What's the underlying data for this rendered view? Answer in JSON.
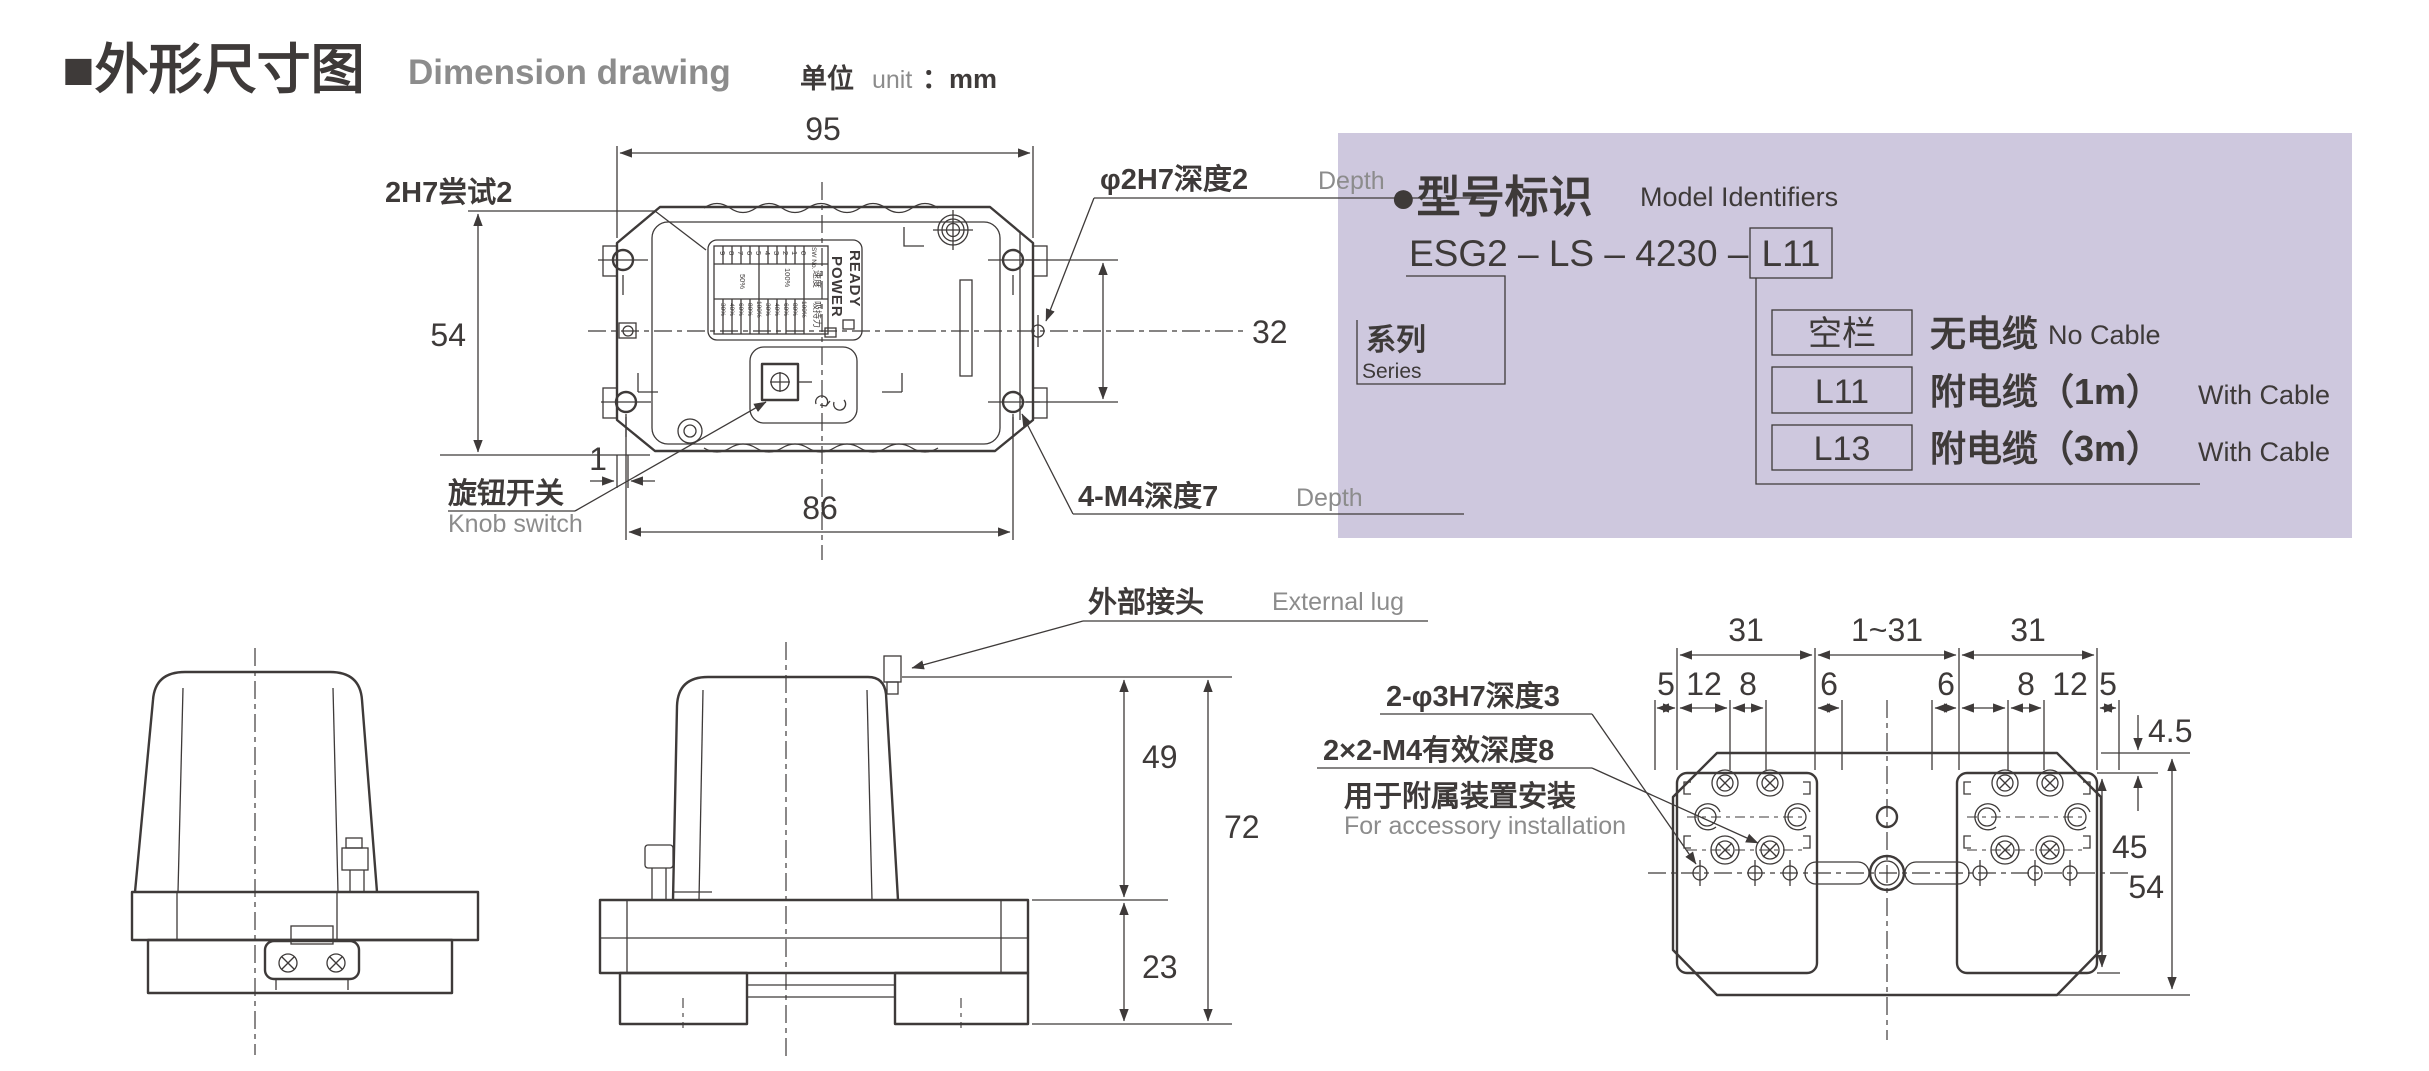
{
  "colors": {
    "ink": "#3e3a39",
    "gray": "#8c8c8c",
    "panel_bg": "#cec8de"
  },
  "header": {
    "title": "■外形尺寸图",
    "subtitle": "Dimension drawing",
    "unit_zh": "单位",
    "unit_en": "unit",
    "unit_value": "：mm"
  },
  "top_view": {
    "dim_width": "95",
    "dim_height": "54",
    "dim_holes_v": "32",
    "dim_holes_h": "86",
    "dim_offset": "1",
    "label_pin_left": "2H7尝试2",
    "label_pin_right": "φ2H7深度2",
    "label_pin_right_en": "Depth",
    "label_knob": "旋钮开关",
    "label_knob_en": "Knob switch",
    "label_holes": "4-M4深度7",
    "label_holes_en": "Depth",
    "panel": {
      "ready": "READY",
      "power": "POWER",
      "sw_no": "SW No.",
      "speed": "速度",
      "force": "吸持力",
      "numbers": [
        "0",
        "1",
        "2",
        "3",
        "4",
        "5",
        "6",
        "7",
        "8",
        "9"
      ],
      "speed_values": [
        "100%",
        "50%"
      ],
      "force_values": [
        "100%",
        "80%",
        "60%",
        "40%",
        "30%",
        "100%",
        "80%",
        "60%",
        "40%",
        "30%"
      ]
    }
  },
  "front_view": {
    "dim_body": "49",
    "dim_total": "72",
    "dim_base": "23",
    "label_lug": "外部接头",
    "label_lug_en": "External lug"
  },
  "bottom_view": {
    "dim_row1": [
      "31",
      "1~31",
      "31"
    ],
    "dim_row2": [
      "5",
      "12",
      "8",
      "6",
      "6",
      "8",
      "12",
      "5"
    ],
    "dim_gap": "4.5",
    "dim_pad": "45",
    "dim_total": "54",
    "label_pins": "2-φ3H7深度3",
    "label_m4": "2×2-M4有效深度8",
    "label_m4_2": "用于附属装置安装",
    "label_m4_en": "For accessory installation"
  },
  "model_panel": {
    "heading": "●型号标识",
    "heading_en": "Model Identifiers",
    "code_prefix": "ESG2 – LS – 4230 –",
    "code_suffix": "L11",
    "series": "系列",
    "series_en": "Series",
    "options": [
      {
        "code": "空栏",
        "zh": "无电缆",
        "en": "No Cable"
      },
      {
        "code": "L11",
        "zh": "附电缆（1m）",
        "en": "With Cable"
      },
      {
        "code": "L13",
        "zh": "附电缆（3m）",
        "en": "With Cable"
      }
    ]
  }
}
